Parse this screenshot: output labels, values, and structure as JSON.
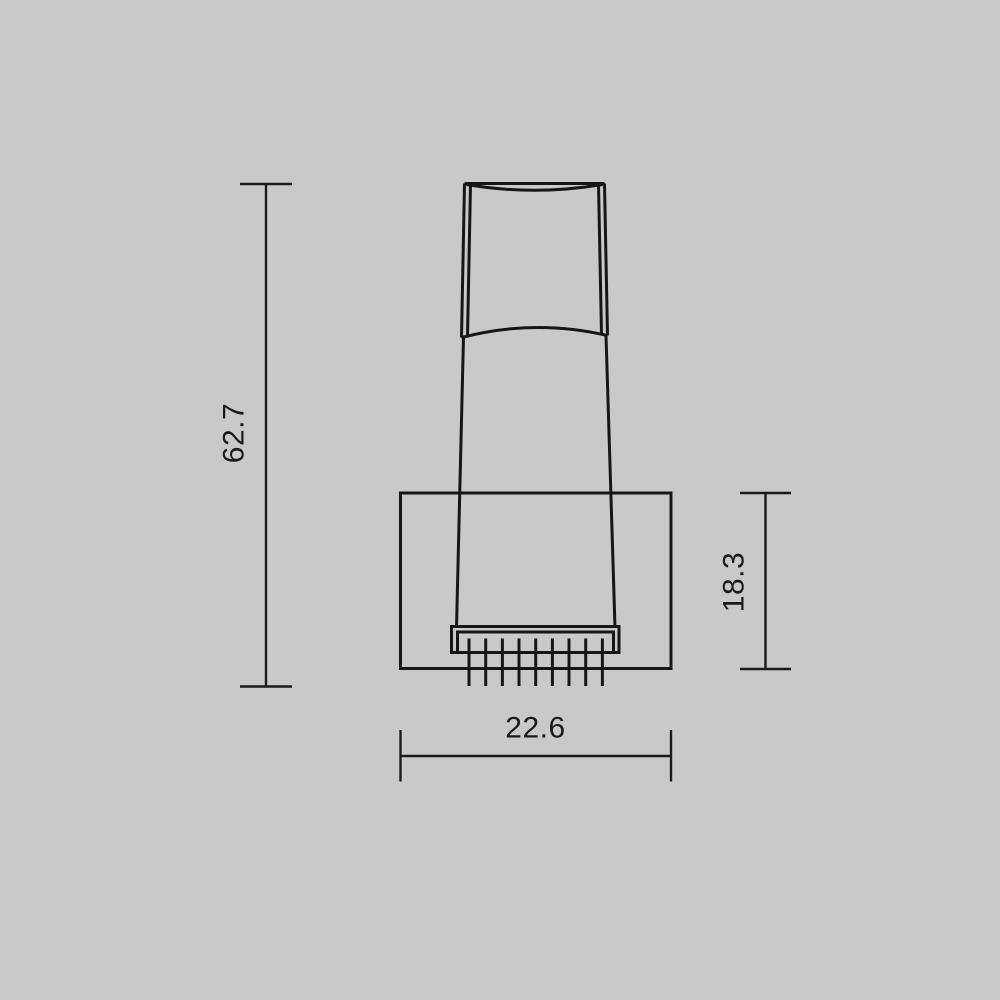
{
  "page": {
    "background_color": "#c9c9c9",
    "line_color": "#161616",
    "text_color": "#1a1a1a"
  },
  "drawing": {
    "type": "technical-dimension-drawing",
    "subject": "wall-fixture-front-view",
    "dimensions": {
      "overall_height": {
        "value": "62.7",
        "orientation": "vertical",
        "position": "left"
      },
      "base_height": {
        "value": "18.3",
        "orientation": "vertical",
        "position": "right"
      },
      "base_width": {
        "value": "22.6",
        "orientation": "horizontal",
        "position": "bottom"
      }
    }
  }
}
